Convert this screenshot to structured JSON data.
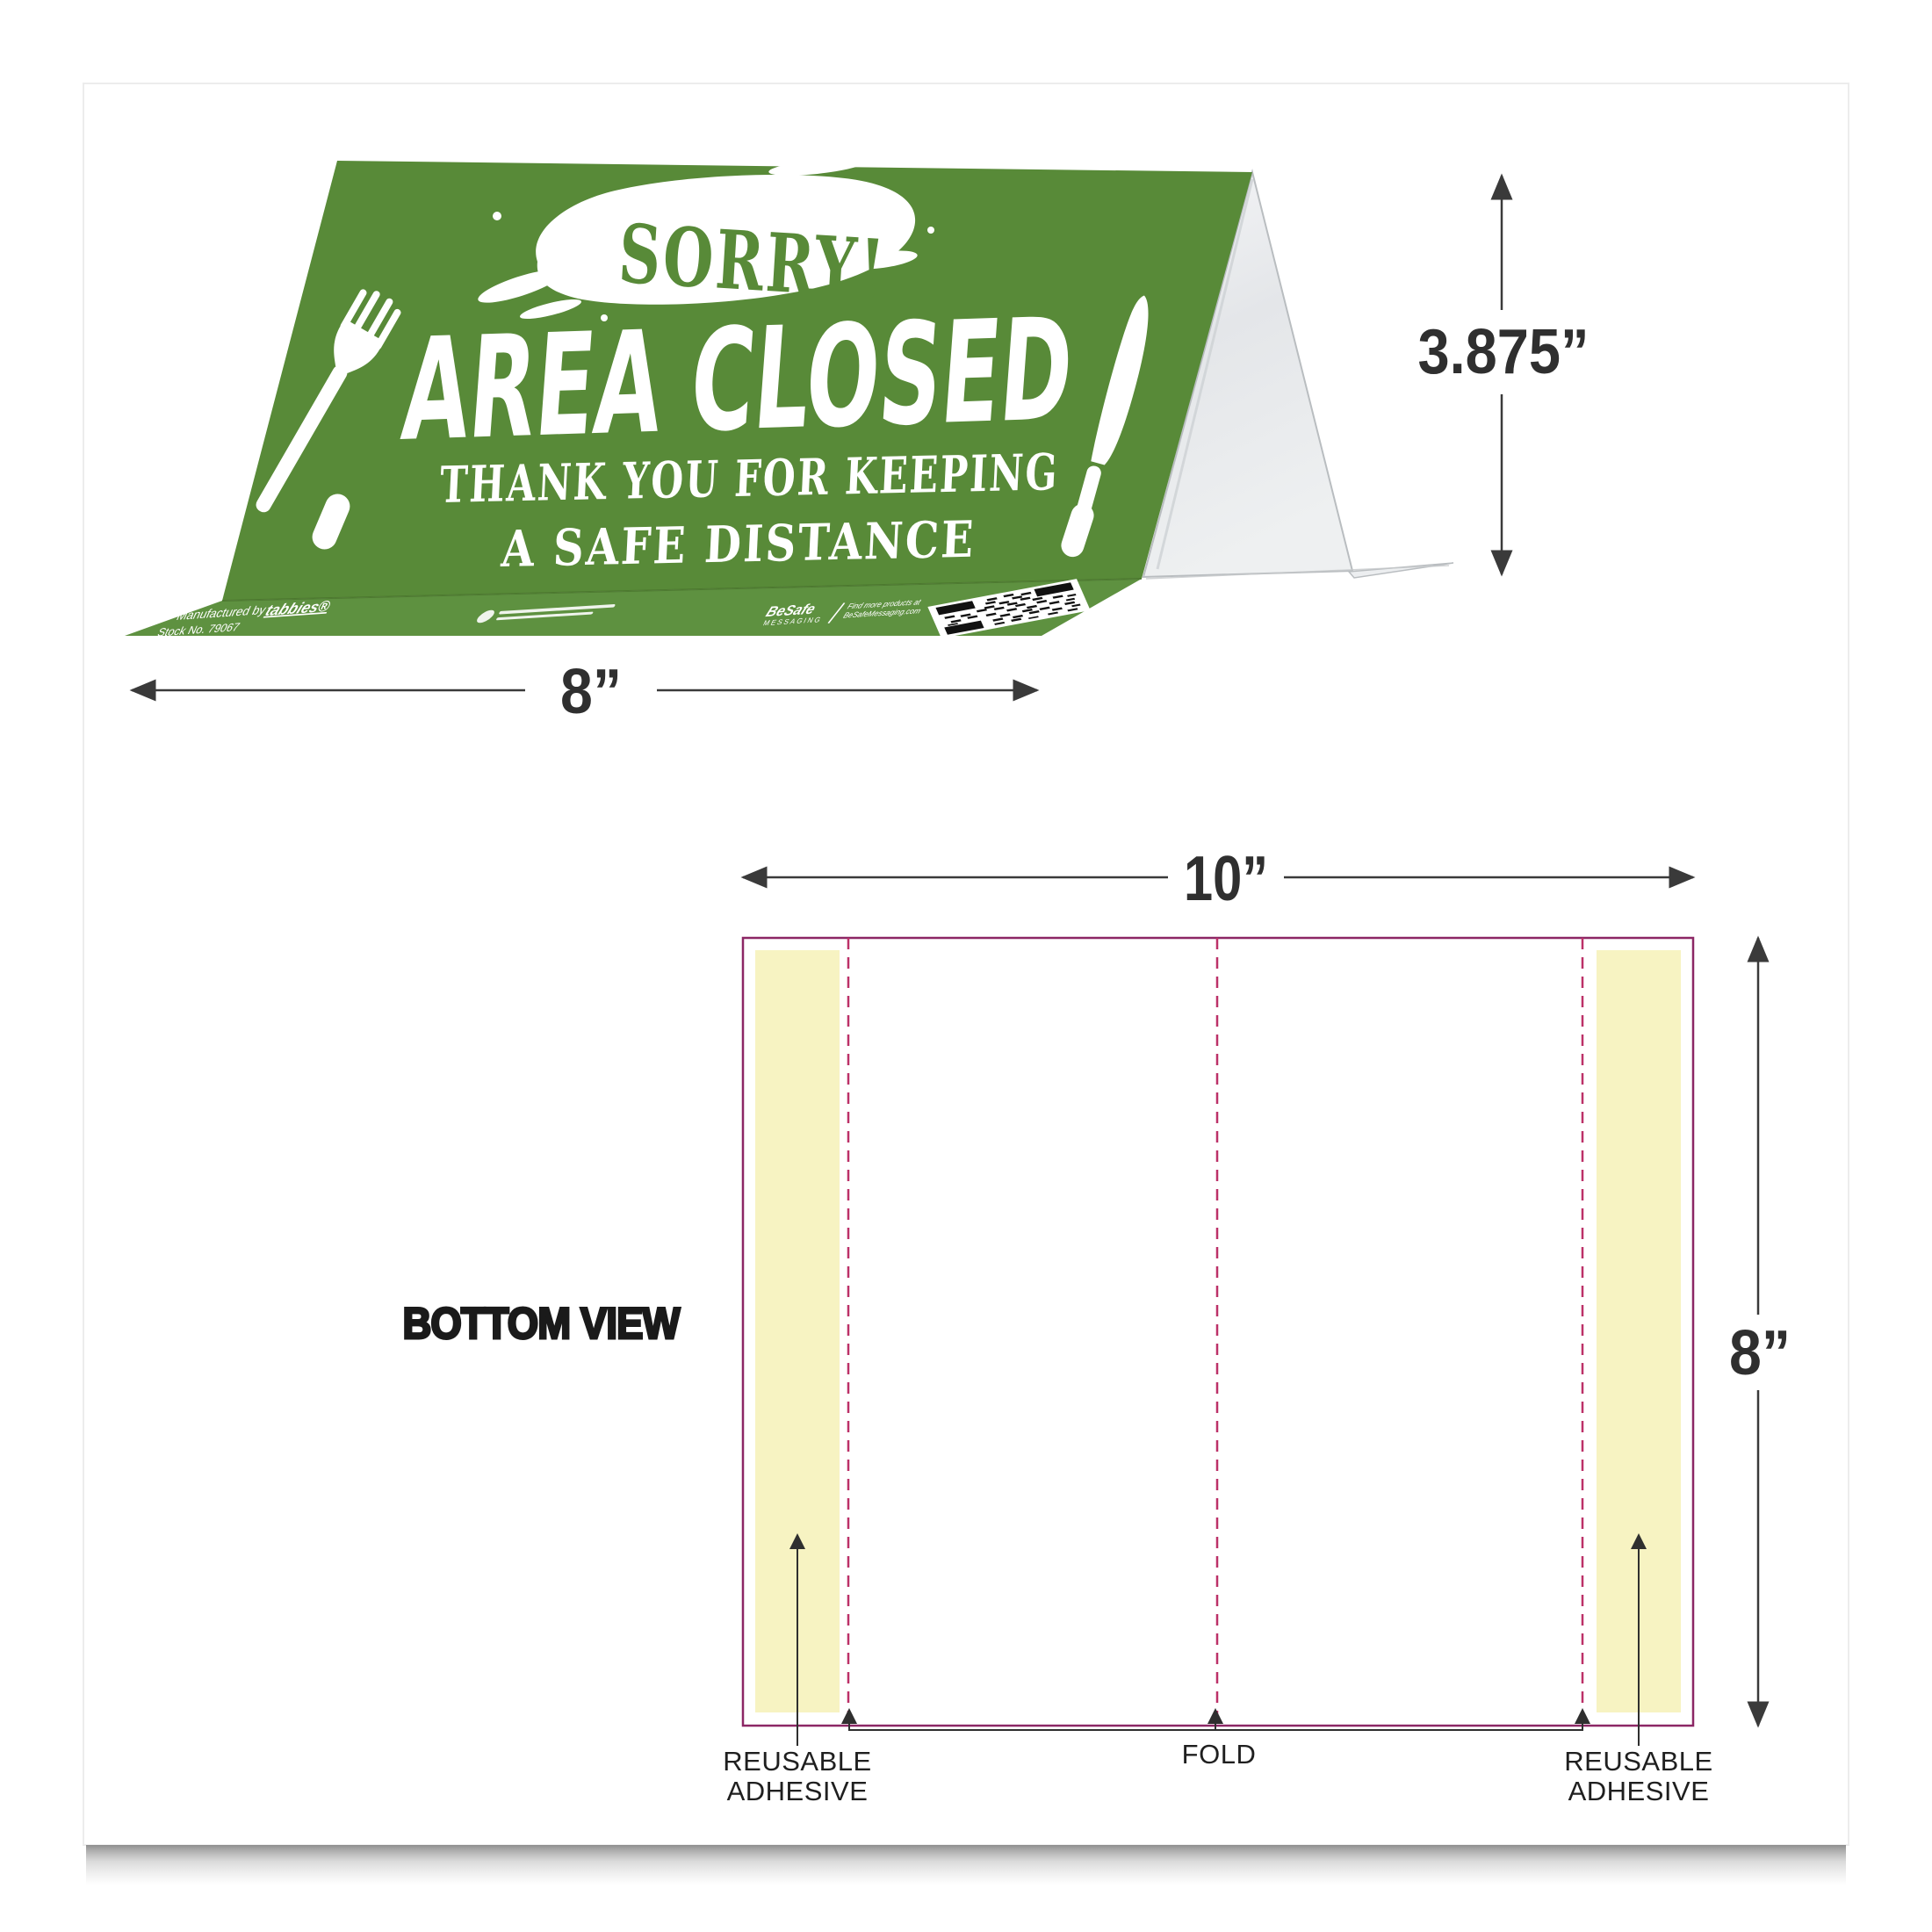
{
  "tent_card": {
    "sorry": "SORRY!",
    "headline": "AREA CLOSED",
    "subline1": "THANK YOU FOR KEEPING",
    "subline2": "A SAFE DISTANCE",
    "flap": {
      "manufactured_by": "Manufactured by",
      "brand": "tabbies®",
      "stock_no": "Stock No. 79067",
      "besafe": "BeSafe",
      "messaging": "MESSAGING",
      "find_more": "Find more products at",
      "site": "BeSafeMessaging.com"
    }
  },
  "dimensions": {
    "tent_width": "8”",
    "tent_height": "3.875”",
    "sheet_width": "10”",
    "sheet_height": "8”"
  },
  "bottom_view": {
    "title": "BOTTOM VIEW",
    "fold": "FOLD",
    "adhesive_line1": "REUSABLE",
    "adhesive_line2": "ADHESIVE"
  },
  "colors": {
    "tent-green": "#588a38",
    "flap-green": "#5e9140",
    "adhesive-yellow": "#f7f3c2",
    "outline-magenta": "#8c2765",
    "dash-magenta": "#bc3168",
    "dim-line": "#3a3a3a",
    "text-dark": "#1f1f1f"
  }
}
